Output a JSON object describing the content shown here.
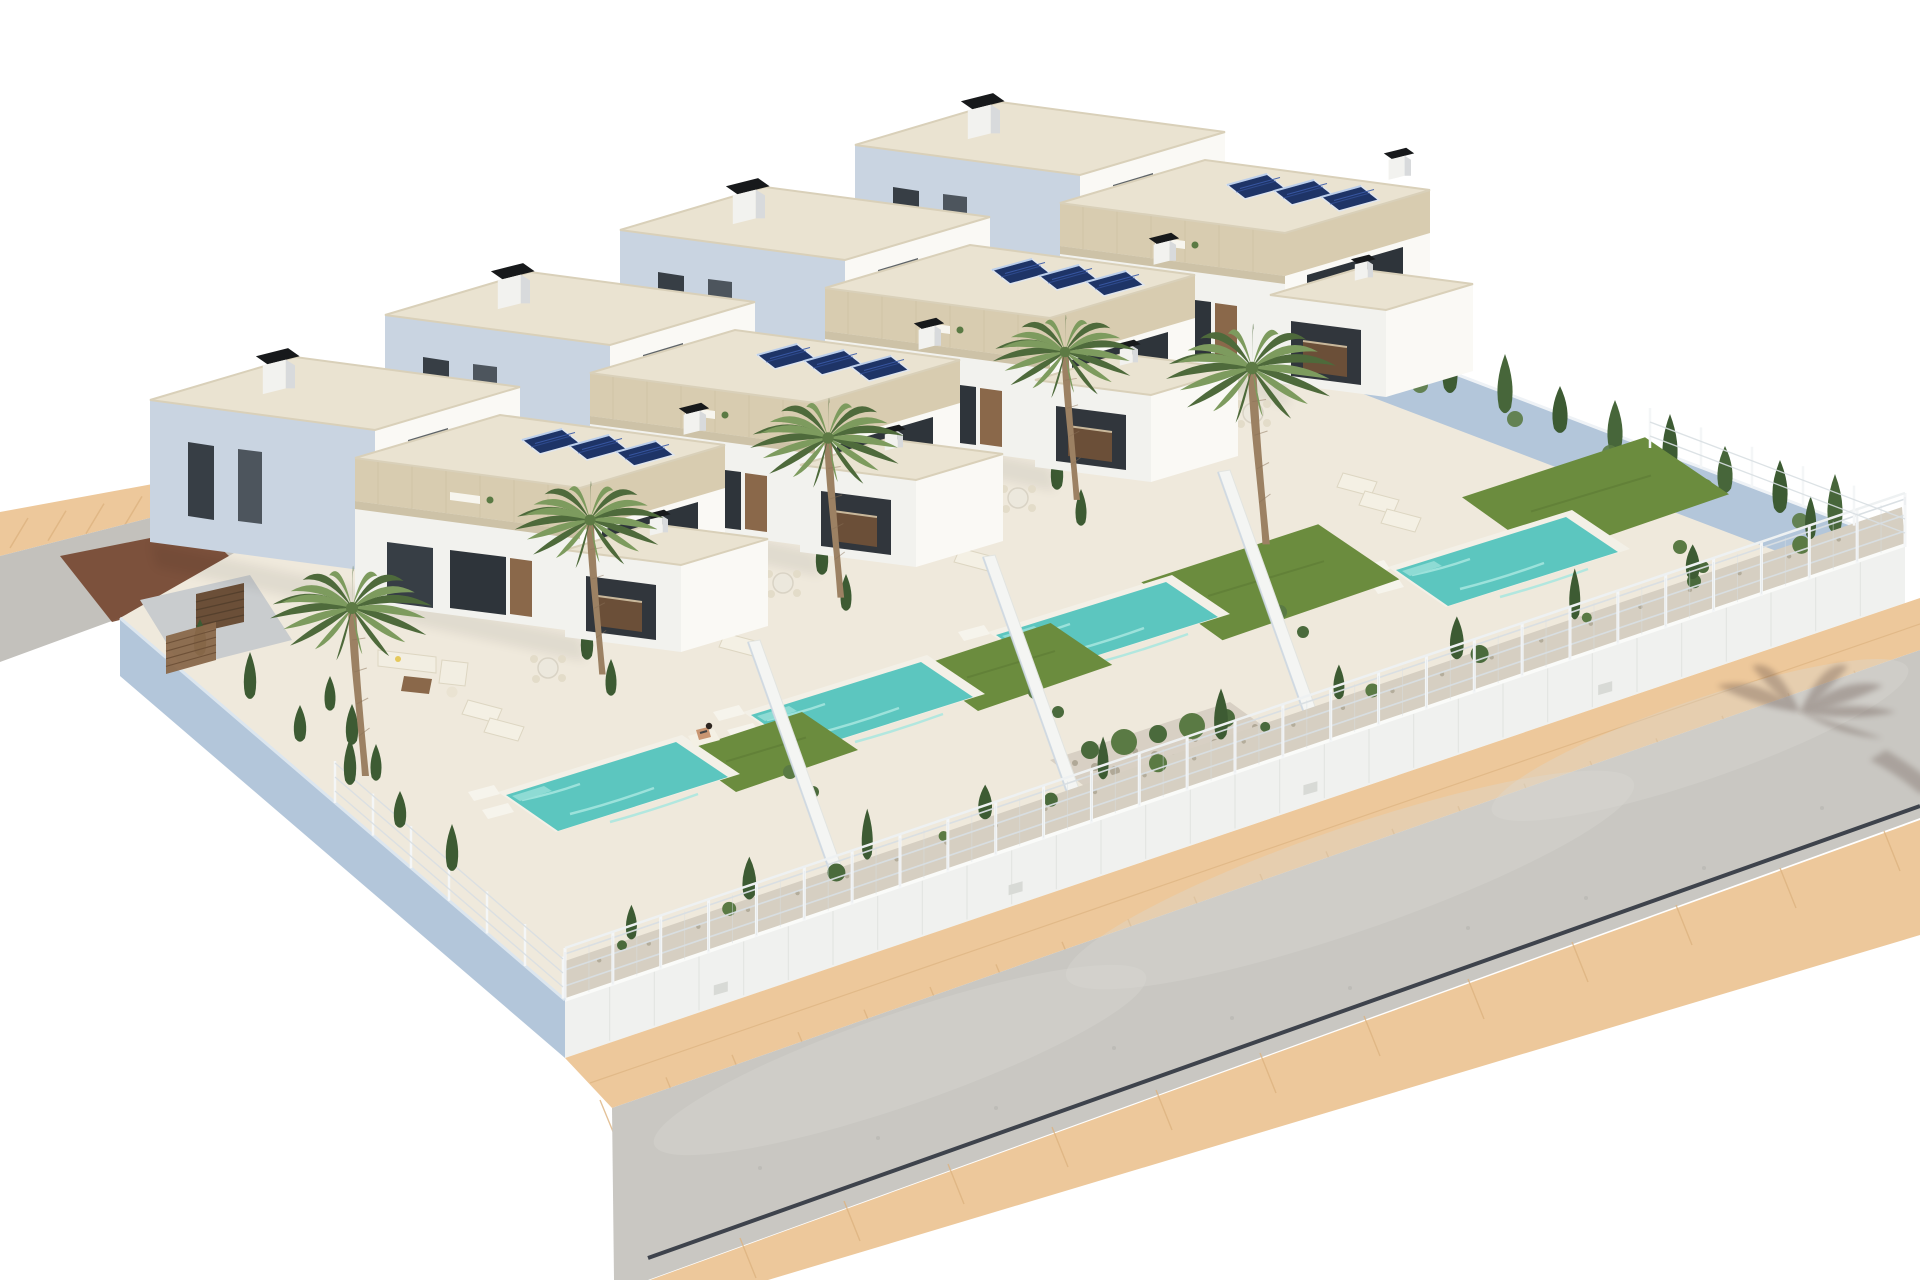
{
  "scene": {
    "type": "architectural-3d-render",
    "description": "Aerial 3D architectural rendering of a row of four modern two-storey white villas with travertine stone fascias, flat roofs with solar panels and black chimney caps, private turquoise pools, lawns, cypress shrubs and palm trees, enclosed by white walls with wire mesh fencing, beside a curving asphalt road with sand-coloured sidewalks, on a plain white background"
  },
  "palette": {
    "bg": "#ffffff",
    "wall_lit": "#faf9f5",
    "wall_soft": "#f2f2ee",
    "wall_cool": "#c9d4e1",
    "wall_shadow_blue": "#b3c6da",
    "roof": "#eae3d1",
    "roof_edge": "#d9d0b9",
    "stone": "#d8ccb0",
    "stone_dark": "#c9bc9e",
    "glass": "#373e45",
    "glass_dark": "#2e343a",
    "wood": "#8a684a",
    "wood_dark": "#6b4f38",
    "solar": "#1e3467",
    "solar_cell": "#3a5aa8",
    "solar_frame": "#dfe5ee",
    "chimney": "#17191b",
    "pool_rim": "#f3f0e7",
    "pool": "#5cc6bf",
    "pool_light": "#a7e6df",
    "lawn": "#6b8c3e",
    "lawn_dark": "#5a7833",
    "cypress": "#3d5b33",
    "shrub": "#5a7a44",
    "palm_light": "#7d9b5e",
    "palm_dark": "#4e6a3b",
    "trunk": "#9c8163",
    "gravel": "#d6cfc2",
    "gravel_dot": "#b0a897",
    "sand": "#edc89b",
    "sand_line": "#ddb380",
    "road": "#c9c7c2",
    "road_light": "#dbd9d4",
    "curb": "#3e434c",
    "fence_white": "#f4f6f7",
    "fence_wire": "#d9dfe3",
    "courtyard": "#c9ccce",
    "driveway_patch": "#74452e",
    "tree_shadow": "#5a453c",
    "person_skin": "#c99672",
    "person_hair": "#2e2620"
  },
  "inventory": {
    "villas": 4,
    "storeys_per_villa": 2,
    "pools": 4,
    "solar_panel_arrays": 4,
    "solar_panels_per_array": 3,
    "chimneys_per_villa": 3,
    "palm_trees": 5,
    "sun_loungers": 9,
    "outdoor_sofa_sets": 4,
    "dining_sets": 4,
    "people": 1,
    "boundary": "white perimeter walls with white wire-mesh fence",
    "street": "asphalt road with sand-coloured sidewalks and a side street at the left",
    "road_markings": "dark curb line along the lower edge",
    "cast_shadows": "palm tree shadow on the road at the right"
  }
}
